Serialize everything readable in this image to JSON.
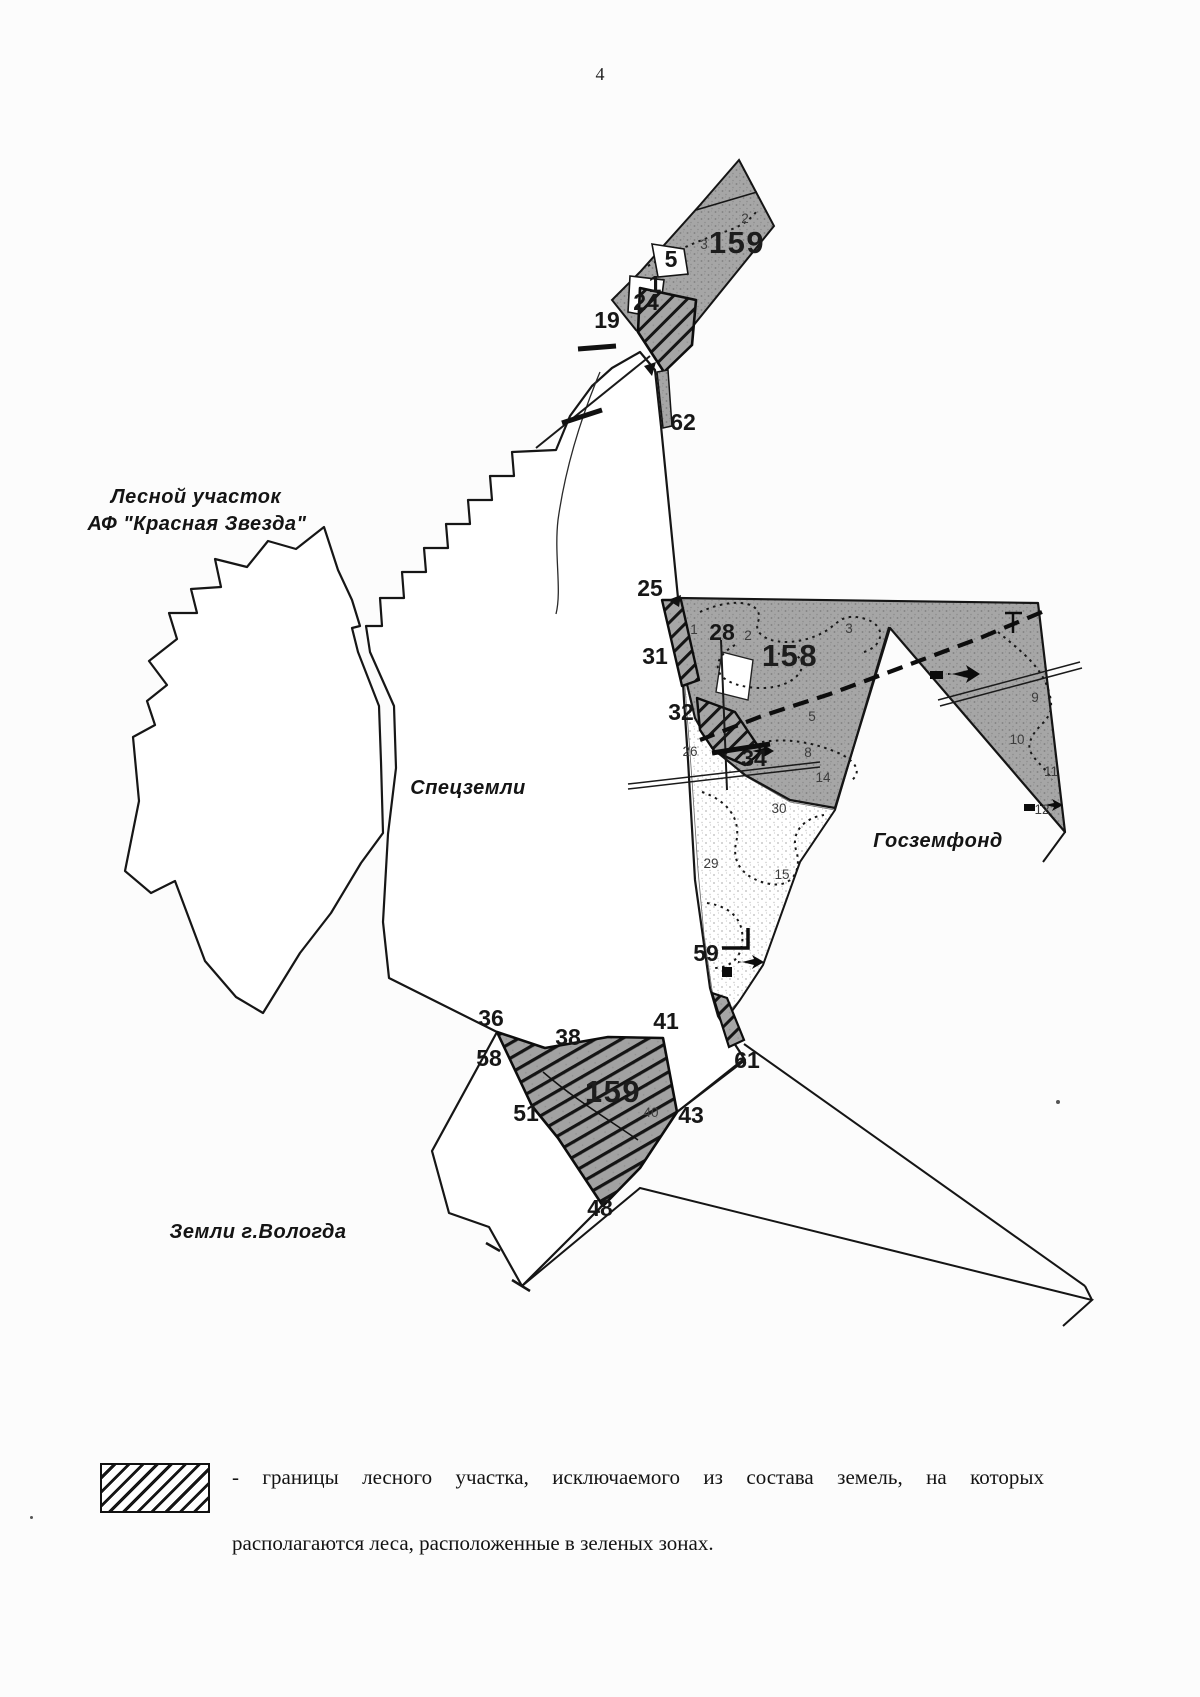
{
  "page": {
    "number": "4"
  },
  "legend": {
    "swatch_meaning": "hatched-area",
    "line1": "-  границы  лесного  участка,  исключаемого  из  состава  земель,  на  которых",
    "line2": "располагаются леса, расположенные в зеленых зонах."
  },
  "map": {
    "colors": {
      "forest_gray": "#a4a4a4",
      "stipple_dot": "#828282",
      "line": "#141414"
    },
    "area_labels": [
      {
        "text": "Лесной  участок",
        "x": 196,
        "y": 503
      },
      {
        "text": "АФ  \"Красная  Звезда\"",
        "x": 197,
        "y": 530
      },
      {
        "text": "Спецземли",
        "x": 468,
        "y": 794
      },
      {
        "text": "Госземфонд",
        "x": 938,
        "y": 847
      },
      {
        "text": "Земли г.Вологда",
        "x": 258,
        "y": 1238
      }
    ],
    "quarter_labels": [
      {
        "text": "159",
        "x": 737,
        "y": 253,
        "size": 30
      },
      {
        "text": "158",
        "x": 790,
        "y": 666
      },
      {
        "text": "159",
        "x": 613,
        "y": 1102,
        "size": 30
      }
    ],
    "point_labels": [
      {
        "text": "19",
        "x": 607,
        "y": 328
      },
      {
        "text": "24",
        "x": 646,
        "y": 310,
        "size": 20
      },
      {
        "text": "5",
        "x": 671,
        "y": 267,
        "size": 19
      },
      {
        "text": "1",
        "x": 655,
        "y": 292,
        "size": 17
      },
      {
        "text": "62",
        "x": 683,
        "y": 430,
        "size": 19
      },
      {
        "text": "25",
        "x": 650,
        "y": 596
      },
      {
        "text": "28",
        "x": 722,
        "y": 640
      },
      {
        "text": "31",
        "x": 655,
        "y": 664
      },
      {
        "text": "32",
        "x": 681,
        "y": 720
      },
      {
        "text": "34",
        "x": 754,
        "y": 766
      },
      {
        "text": "59",
        "x": 706,
        "y": 961
      },
      {
        "text": "36",
        "x": 491,
        "y": 1026
      },
      {
        "text": "38",
        "x": 568,
        "y": 1045
      },
      {
        "text": "41",
        "x": 666,
        "y": 1029
      },
      {
        "text": "58",
        "x": 489,
        "y": 1066
      },
      {
        "text": "61",
        "x": 747,
        "y": 1068
      },
      {
        "text": "51",
        "x": 526,
        "y": 1121
      },
      {
        "text": "43",
        "x": 691,
        "y": 1123
      },
      {
        "text": "48",
        "x": 600,
        "y": 1216
      }
    ],
    "parcel_labels": [
      {
        "text": "2",
        "x": 745,
        "y": 223
      },
      {
        "text": "3",
        "x": 704,
        "y": 249
      },
      {
        "text": "1",
        "x": 694,
        "y": 634
      },
      {
        "text": "2",
        "x": 748,
        "y": 640
      },
      {
        "text": "3",
        "x": 849,
        "y": 633
      },
      {
        "text": "5",
        "x": 812,
        "y": 721
      },
      {
        "text": "8",
        "x": 808,
        "y": 757
      },
      {
        "text": "14",
        "x": 823,
        "y": 782
      },
      {
        "text": "26",
        "x": 690,
        "y": 756
      },
      {
        "text": "30",
        "x": 779,
        "y": 813
      },
      {
        "text": "29",
        "x": 711,
        "y": 868
      },
      {
        "text": "15",
        "x": 782,
        "y": 879
      },
      {
        "text": "9",
        "x": 1035,
        "y": 702
      },
      {
        "text": "10",
        "x": 1017,
        "y": 744
      },
      {
        "text": "11",
        "x": 1051,
        "y": 776
      },
      {
        "text": "12",
        "x": 1042,
        "y": 814
      },
      {
        "text": "40",
        "x": 651,
        "y": 1117
      }
    ]
  }
}
